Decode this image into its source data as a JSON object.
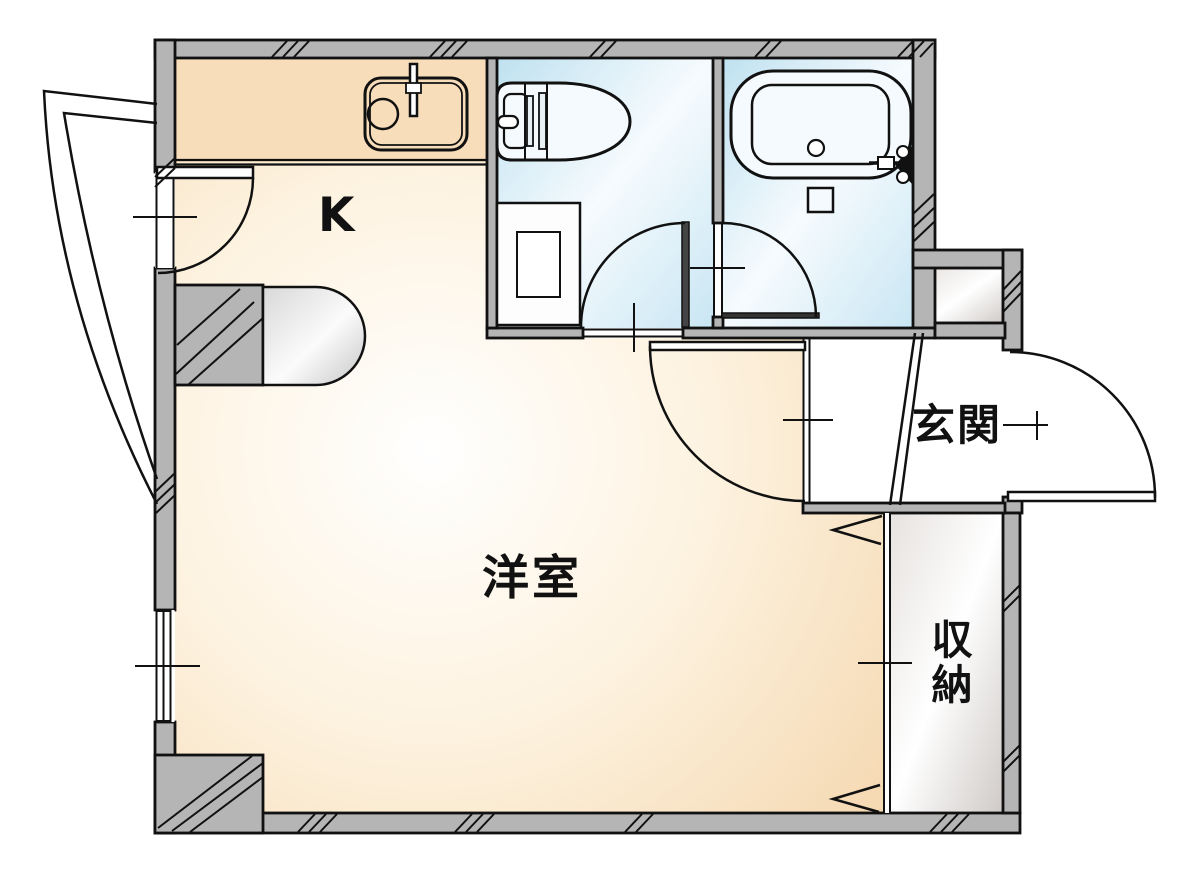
{
  "floorplan": {
    "type": "japanese-apartment-floor-plan",
    "rooms": {
      "kitchen": {
        "label": "K"
      },
      "western_room": {
        "label": "洋室"
      },
      "entrance": {
        "label": "玄関"
      },
      "storage": {
        "label": "収納"
      }
    },
    "fixtures": [
      "kitchen-sink-icon",
      "kitchen-faucet-icon",
      "toilet-icon",
      "toilet-cabinet-icon",
      "bathtub-icon",
      "bath-faucet-icon",
      "shower-control-icon",
      "window-icon",
      "door-swing-icon",
      "closet-folding-door-icon"
    ],
    "colors": {
      "wall": "#b5b5b5",
      "line": "#111111",
      "floor_highlight": "#ffffff",
      "floor_warm": "#f3d3a8",
      "floor_warm_mid": "#fdf2df",
      "counter": "#f8ddbb",
      "wet_blue": "#bfe1f0",
      "wet_highlight": "#f6fbfe",
      "wet_edge": "#c9e6f3",
      "storage_gray": "#cfcac7",
      "storage_highlight": "#ffffff",
      "storage_edge": "#e6e2df",
      "capsule_gray": "#c6c6c6",
      "entrance_floor": "#ffffff",
      "fixture_fill": "#f4fafd"
    }
  }
}
